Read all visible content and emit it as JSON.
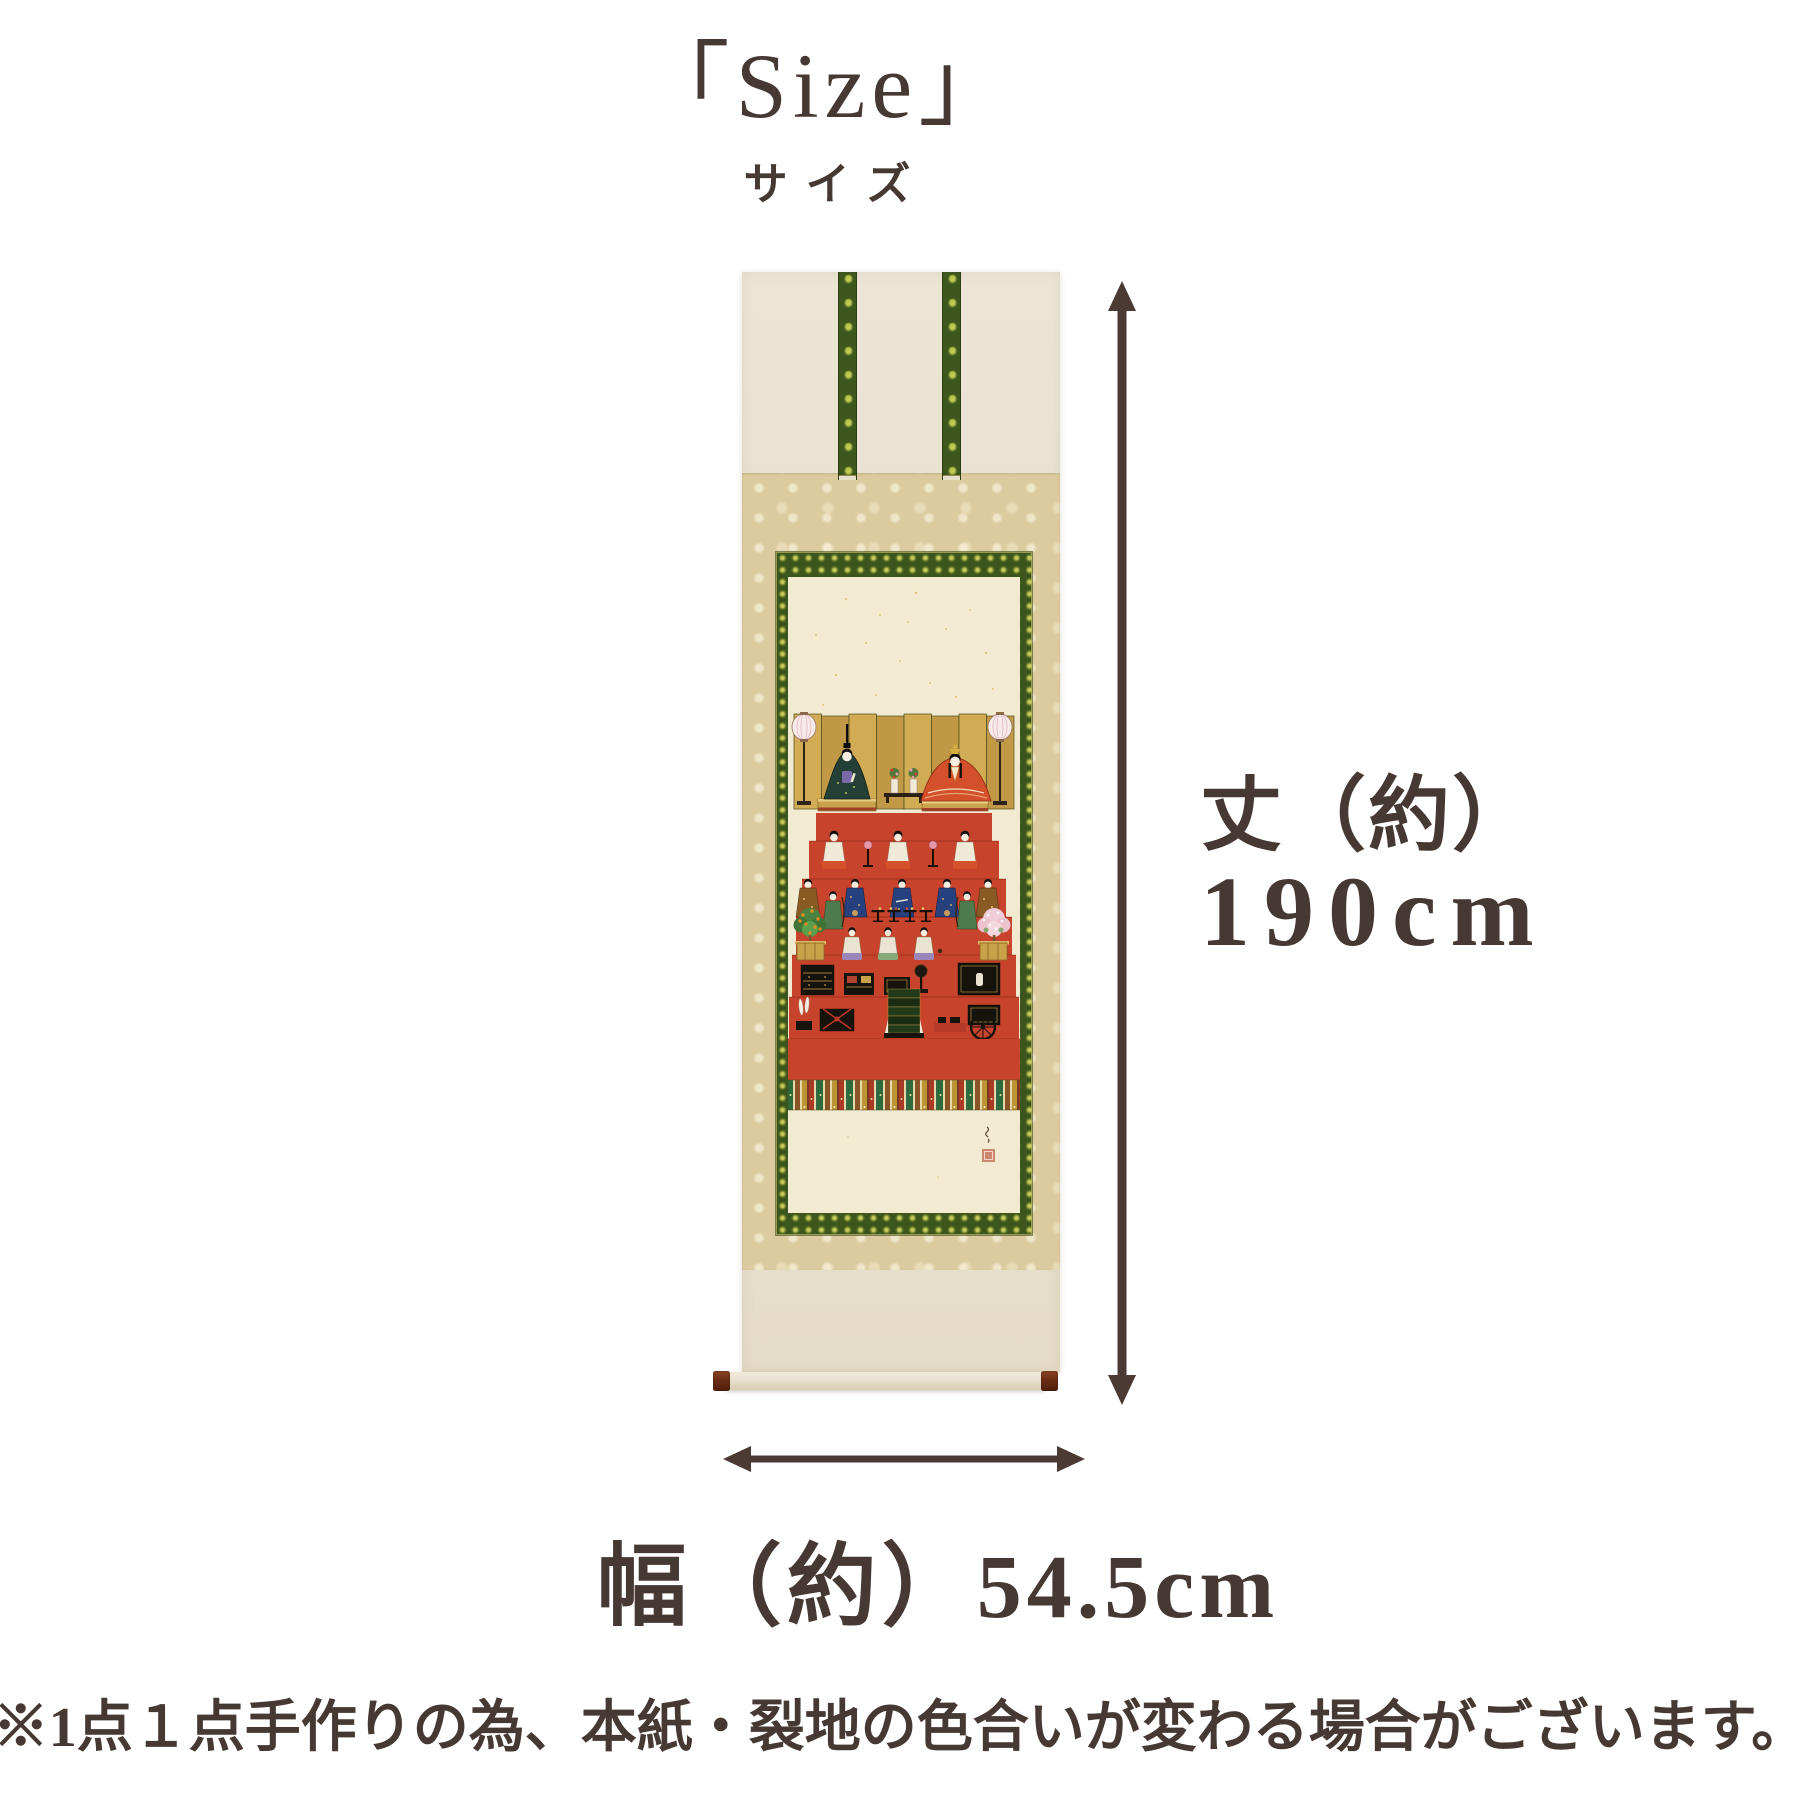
{
  "title": {
    "main": "「Size」",
    "sub": "サイズ"
  },
  "dimensions": {
    "height_label": "丈（約）",
    "height_value": "190cm",
    "width_label": "幅（約）",
    "width_value": "54.5cm"
  },
  "note": "※1点１点手作りの為、本紙・裂地の色合いが変わる場合がございます。",
  "product": {
    "subject": "雛人形七段飾りの掛軸（かけじく）",
    "mount_parts": [
      "風帯",
      "中廻し",
      "一文字",
      "本紙",
      "軸先"
    ]
  },
  "colors": {
    "text": "#463832",
    "arrow": "#4b3a33",
    "mount_cream": "#e9e2d2",
    "mount_beige": "#dccb9f",
    "brocade_green": "#3c551c",
    "painting_paper": "#f3ebd1",
    "tier_red": "#c7432b",
    "roller_knob": "#6b2d14"
  }
}
